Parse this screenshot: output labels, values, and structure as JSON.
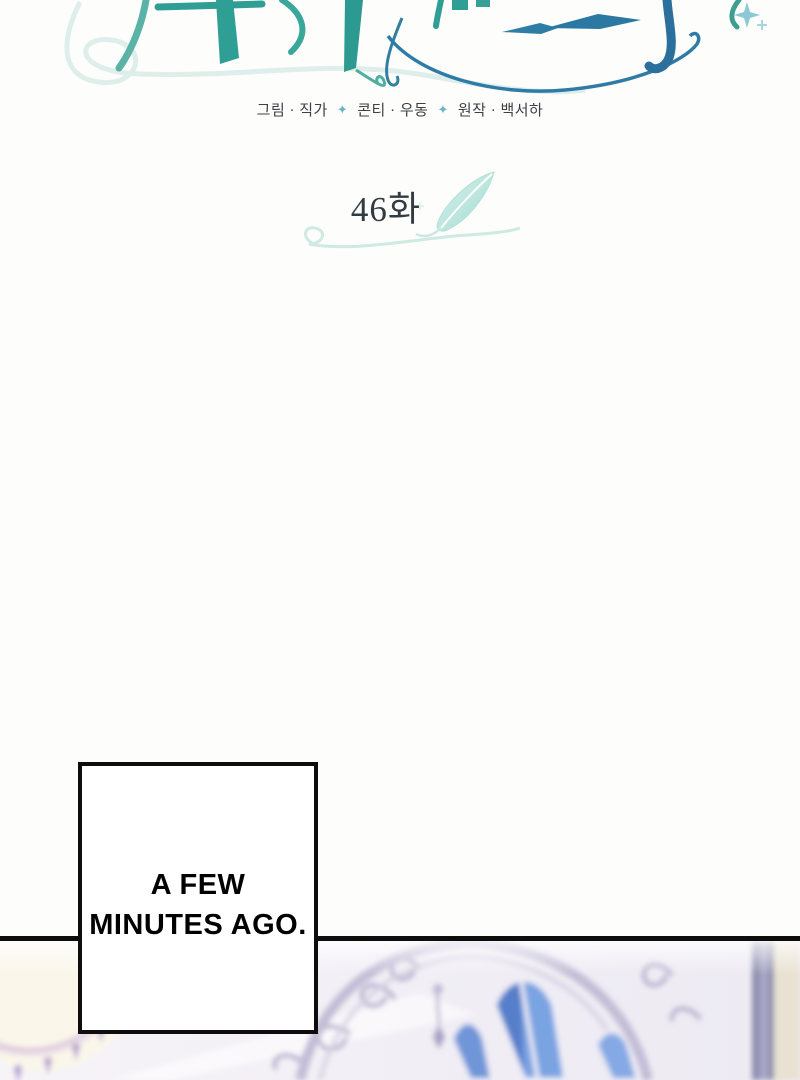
{
  "header": {
    "credits": {
      "separator": "✦",
      "groups": [
        "그림 · 직가",
        "콘티 · 우동",
        "원작 · 백서하"
      ]
    },
    "episode": {
      "label": "46화"
    }
  },
  "caption": {
    "line1": "A FEW",
    "line2": "MINUTES AGO."
  },
  "colors": {
    "accent_teal": "#2f9e94",
    "accent_blue": "#2b6f9c",
    "feather_aqua": "#c4e9e2",
    "diamond_separator": "#6ab5c4",
    "panel_border": "#0d0d0d",
    "illustration_lavender": "#b5afcc",
    "illustration_blue_glass": "#7aa3e2"
  }
}
